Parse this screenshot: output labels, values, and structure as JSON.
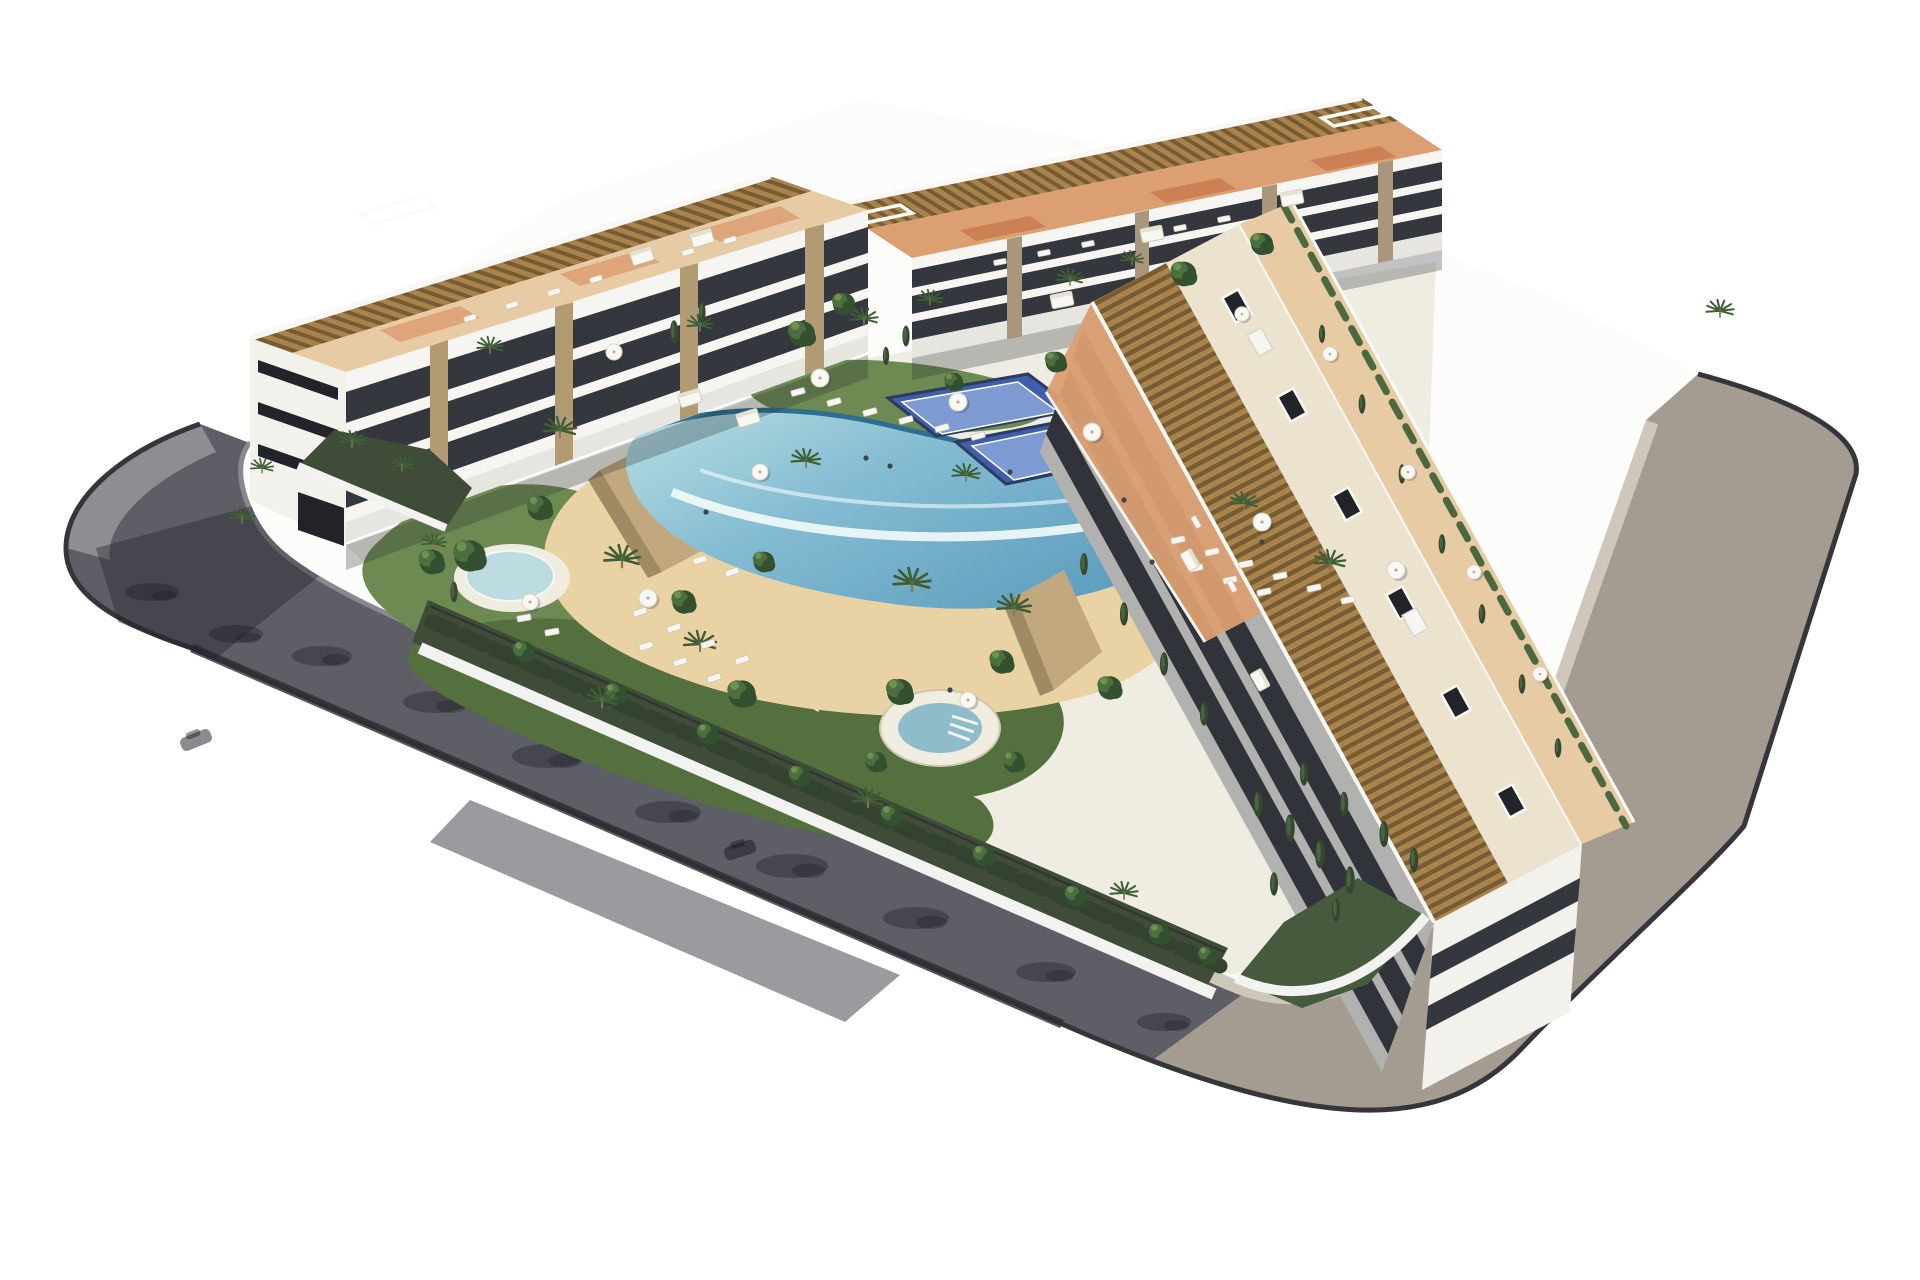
{
  "scene": {
    "title": "Aerial 3D architectural render of a modern white apartment complex with three residential blocks around a landscaped courtyard with a lagoon pool, beach entry, round jacuzzi, pond, padel courts, palm gardens and a perimeter ring road",
    "type": "architectural-render",
    "labels": {
      "building_left": "west apartment block with rooftop pergola terraces",
      "building_north": "north apartment block with rooftop pergola terraces",
      "building_east": "east apartment block with pergola roof strip and street-side terraces",
      "pool": "free-form communal lagoon pool with infinity edge and sand beach entry",
      "pond": "small round splash pond with white deck ring",
      "jacuzzi": "circular raised jacuzzi spa",
      "padel": "two blue padel courts",
      "road_left": "dark asphalt perimeter road (shaded side)",
      "road_right": "warm grey perimeter road with beige sidewalk",
      "gardens": "perimeter gardens with palms, shrubs and cypresses"
    }
  },
  "palette": {
    "bg": "#ffffff",
    "road_asphalt": "#5e5e66",
    "road_warm": "#a49c90",
    "sidewalk_gray": "#8f8f96",
    "sidewalk_beige": "#cfc7ba",
    "curb": "#35353b",
    "ground_white": "#fcfcfb",
    "courtyard_base": "#efece2",
    "wall_white": "#f2f2f0",
    "facade_white": "#f2f1ec",
    "facade_light": "#f6f5f1",
    "facade_base": "#e7e5df",
    "facade_dark_row": "#34373d",
    "window_dark": "#22242a",
    "stone_pillar": "#b29a72",
    "stone_pillar_dark": "#a8977a",
    "roof_cream": "#ece3cf",
    "terrace_tan": "#e7cba4",
    "terrace_orange": "#db9f72",
    "tile_orange": "#c97d50",
    "pergola_light": "#a8834c",
    "pergola_dark": "#775c33",
    "sand": "#e9d2a4",
    "pool_light": "#b9dee2",
    "pool_mid": "#84bcd2",
    "pool_deep": "#5f9fbf",
    "pool_edge": "#2f6e8e",
    "foam": "#f2fbfa",
    "lawn": "#6d8a52",
    "lawn_dark": "#55703f",
    "garden_shadow": "#3f4c38",
    "hedge": "#4c683e",
    "tree_dark": "#33502f",
    "tree_mid": "#4c6f3f",
    "palm": "#3f5e38",
    "cypress": "#35482f",
    "padel_blue": "#3f5fae",
    "padel_light": "#7d9bd2",
    "padel_fence": "#2b3c5f",
    "umbrella": "#f8f7f2",
    "lounger": "#f7f6f0",
    "stone_wall": "#c2a87e",
    "stone_wall_dark": "#a08a64",
    "trunk": "#8a7356",
    "water_pond": "#bcdce2",
    "pond_ring": "#efece0",
    "jacuzzi_water": "#8fbccb",
    "shadow": "rgba(30,33,42,0.45)",
    "shade_soft": "rgba(40,46,52,0.28)"
  },
  "stamps": [
    {
      "name": "palm-tree",
      "symbol": "sym-palm",
      "target": "layer-palms",
      "items": [
        [
          352,
          446,
          0.8
        ],
        [
          402,
          470,
          0.7
        ],
        [
          262,
          472,
          0.7
        ],
        [
          560,
          436,
          1
        ],
        [
          622,
          566,
          1.1
        ],
        [
          700,
          650,
          1
        ],
        [
          912,
          590,
          1.15
        ],
        [
          1014,
          614,
          1.05
        ],
        [
          966,
          480,
          0.85
        ],
        [
          1244,
          508,
          0.85
        ],
        [
          1330,
          568,
          0.95
        ],
        [
          864,
          324,
          0.85
        ],
        [
          930,
          304,
          0.75
        ],
        [
          1070,
          284,
          0.8
        ],
        [
          1132,
          264,
          0.7
        ],
        [
          602,
          706,
          0.95
        ],
        [
          868,
          806,
          0.95
        ],
        [
          1124,
          898,
          0.85
        ],
        [
          434,
          548,
          0.75
        ],
        [
          1720,
          316,
          0.85
        ],
        [
          490,
          352,
          0.8
        ],
        [
          242,
          522,
          0.75
        ],
        [
          806,
          466,
          0.9
        ],
        [
          700,
          330,
          0.8
        ]
      ]
    },
    {
      "name": "round-tree",
      "symbol": "sym-tree",
      "target": "layer-trees",
      "items": [
        [
          470,
          556,
          1.2
        ],
        [
          540,
          508,
          0.95
        ],
        [
          742,
          694,
          1.05
        ],
        [
          900,
          692,
          1.0
        ],
        [
          1002,
          662,
          0.9
        ],
        [
          876,
          762,
          0.8
        ],
        [
          1014,
          762,
          0.8
        ],
        [
          432,
          562,
          0.95
        ],
        [
          802,
          334,
          1
        ],
        [
          844,
          304,
          0.85
        ],
        [
          1184,
          274,
          0.95
        ],
        [
          1262,
          244,
          0.85
        ],
        [
          524,
          652,
          0.8
        ],
        [
          616,
          694,
          0.8
        ],
        [
          708,
          734,
          0.8
        ],
        [
          800,
          776,
          0.8
        ],
        [
          892,
          816,
          0.8
        ],
        [
          984,
          856,
          0.8
        ],
        [
          1076,
          896,
          0.8
        ],
        [
          1160,
          934,
          0.8
        ],
        [
          1208,
          956,
          0.7
        ],
        [
          684,
          602,
          0.9
        ],
        [
          764,
          562,
          0.8
        ],
        [
          1056,
          362,
          0.8
        ],
        [
          954,
          382,
          0.7
        ],
        [
          1110,
          688,
          0.9
        ]
      ]
    },
    {
      "name": "cypress-tree",
      "symbol": "sym-cypress",
      "target": "layer-cypress",
      "items": [
        [
          1258,
          804,
          1
        ],
        [
          1290,
          828,
          1.05
        ],
        [
          1320,
          854,
          1.1
        ],
        [
          1350,
          880,
          1.05
        ],
        [
          1304,
          774,
          0.9
        ],
        [
          1344,
          804,
          0.95
        ],
        [
          1384,
          834,
          1
        ],
        [
          1414,
          860,
          0.95
        ],
        [
          1274,
          884,
          0.9
        ],
        [
          1336,
          910,
          0.9
        ],
        [
          1084,
          564,
          0.85
        ],
        [
          1124,
          614,
          0.9
        ],
        [
          1164,
          664,
          0.9
        ],
        [
          1204,
          714,
          0.9
        ],
        [
          1322,
          334,
          0.7
        ],
        [
          1362,
          404,
          0.75
        ],
        [
          1402,
          474,
          0.75
        ],
        [
          1442,
          544,
          0.75
        ],
        [
          1482,
          614,
          0.75
        ],
        [
          1522,
          684,
          0.75
        ],
        [
          1558,
          748,
          0.75
        ],
        [
          454,
          592,
          0.8
        ],
        [
          674,
          332,
          0.9
        ],
        [
          702,
          312,
          0.8
        ],
        [
          906,
          336,
          0.8
        ],
        [
          886,
          356,
          0.7
        ]
      ]
    },
    {
      "name": "sun-lounger",
      "symbol": "sym-lounger",
      "target": "layer-loungers",
      "items": [
        [
          798,
          392,
          1,
          -15
        ],
        [
          834,
          402,
          1,
          -15
        ],
        [
          870,
          412,
          1,
          -15
        ],
        [
          906,
          420,
          1,
          -15
        ],
        [
          942,
          428,
          1,
          -15
        ],
        [
          978,
          436,
          1,
          -15
        ],
        [
          1178,
          540,
          1,
          -12
        ],
        [
          1212,
          552,
          1,
          -12
        ],
        [
          1246,
          564,
          1,
          -12
        ],
        [
          1280,
          576,
          1,
          -12
        ],
        [
          1314,
          588,
          1,
          -12
        ],
        [
          1348,
          600,
          1,
          -12
        ],
        [
          1196,
          568,
          1,
          -12
        ],
        [
          1230,
          580,
          1,
          -12
        ],
        [
          1264,
          592,
          1,
          -12
        ],
        [
          640,
          612,
          1,
          -18
        ],
        [
          674,
          628,
          1,
          -18
        ],
        [
          708,
          644,
          1,
          -18
        ],
        [
          742,
          660,
          1,
          -18
        ],
        [
          646,
          646,
          1,
          -18
        ],
        [
          680,
          662,
          1,
          -18
        ],
        [
          714,
          678,
          1,
          -18
        ],
        [
          700,
          560,
          1,
          -18
        ],
        [
          732,
          572,
          1,
          -18
        ],
        [
          524,
          618,
          1,
          -10
        ],
        [
          552,
          632,
          1,
          -10
        ],
        [
          470,
          318,
          0.9,
          -17
        ],
        [
          512,
          305,
          0.9,
          -17
        ],
        [
          554,
          292,
          0.9,
          -17
        ],
        [
          596,
          279,
          0.9,
          -17
        ],
        [
          688,
          252,
          0.9,
          -17
        ],
        [
          730,
          240,
          0.9,
          -17
        ],
        [
          1000,
          262,
          0.9,
          -11
        ],
        [
          1044,
          253,
          0.9,
          -11
        ],
        [
          1088,
          244,
          0.9,
          -11
        ],
        [
          1180,
          228,
          0.9,
          -11
        ],
        [
          1224,
          219,
          0.9,
          -11
        ],
        [
          1196,
          522,
          0.9,
          61
        ],
        [
          1232,
          586,
          0.9,
          61
        ]
      ]
    },
    {
      "name": "parasol-umbrella",
      "symbol": "sym-umbrella",
      "target": "layer-umbrellas",
      "items": [
        [
          820,
          378,
          1
        ],
        [
          958,
          402,
          1
        ],
        [
          1092,
          432,
          1
        ],
        [
          1262,
          522,
          1
        ],
        [
          1396,
          570,
          1
        ],
        [
          648,
          598,
          1
        ],
        [
          760,
          472,
          0.9
        ],
        [
          530,
          602,
          0.9
        ],
        [
          1330,
          354,
          0.8
        ],
        [
          1408,
          472,
          0.8
        ],
        [
          1474,
          572,
          0.8
        ],
        [
          1540,
          674,
          0.8
        ],
        [
          614,
          352,
          0.9
        ],
        [
          1242,
          314,
          0.8
        ],
        [
          968,
          700,
          0.9
        ]
      ]
    },
    {
      "name": "daybed",
      "symbol": "sym-daybed",
      "target": "layer-daybeds",
      "items": [
        [
          690,
          398,
          1,
          -17
        ],
        [
          748,
          418,
          1,
          -17
        ],
        [
          642,
          256,
          1,
          -17
        ],
        [
          702,
          238,
          1,
          -17
        ],
        [
          1152,
          234,
          1,
          -11
        ],
        [
          1292,
          198,
          1,
          -11
        ],
        [
          1062,
          300,
          1,
          -11
        ],
        [
          1190,
          560,
          0.9,
          61
        ],
        [
          1260,
          680,
          0.9,
          61
        ]
      ]
    },
    {
      "name": "roof-hatch",
      "symbol": "sym-hatch",
      "target": "layer-hatches",
      "items": [
        [
          1237,
          306,
          1,
          61
        ],
        [
          1292,
          405,
          1,
          61
        ],
        [
          1347,
          504,
          1,
          61
        ],
        [
          1401,
          603,
          1,
          61
        ],
        [
          1456,
          702,
          1,
          61
        ],
        [
          1511,
          801,
          1,
          61
        ]
      ]
    },
    {
      "name": "roof-stair-box",
      "symbol": "sym-box",
      "target": "layer-hatches",
      "items": [
        [
          1260,
          342,
          1,
          61
        ],
        [
          1415,
          622,
          1,
          61
        ]
      ]
    },
    {
      "name": "tree-shadow-on-road",
      "symbol": "sym-roadshadow",
      "target": "layer-roadshadows",
      "items": [
        [
          322,
          656,
          1
        ],
        [
          436,
          702,
          1.1
        ],
        [
          548,
          756,
          1.2
        ],
        [
          668,
          812,
          1.1
        ],
        [
          792,
          866,
          1.2
        ],
        [
          916,
          918,
          1.1
        ],
        [
          1046,
          972,
          1
        ],
        [
          152,
          592,
          0.9
        ],
        [
          236,
          634,
          0.9
        ],
        [
          1164,
          1022,
          0.9
        ]
      ]
    },
    {
      "name": "car-shadow",
      "symbol": "sym-car",
      "target": "layer-roadshadows",
      "items": [
        [
          196,
          740,
          1,
          -22
        ],
        [
          740,
          850,
          1,
          -18
        ]
      ]
    },
    {
      "name": "person",
      "symbol": "sym-person",
      "target": "layer-people",
      "items": [
        [
          866,
          458,
          1
        ],
        [
          890,
          466,
          1
        ],
        [
          1124,
          500,
          1
        ],
        [
          1152,
          562,
          1
        ],
        [
          706,
          512,
          1
        ],
        [
          1010,
          472,
          1
        ],
        [
          1262,
          542,
          1
        ],
        [
          950,
          690,
          1
        ]
      ]
    }
  ]
}
